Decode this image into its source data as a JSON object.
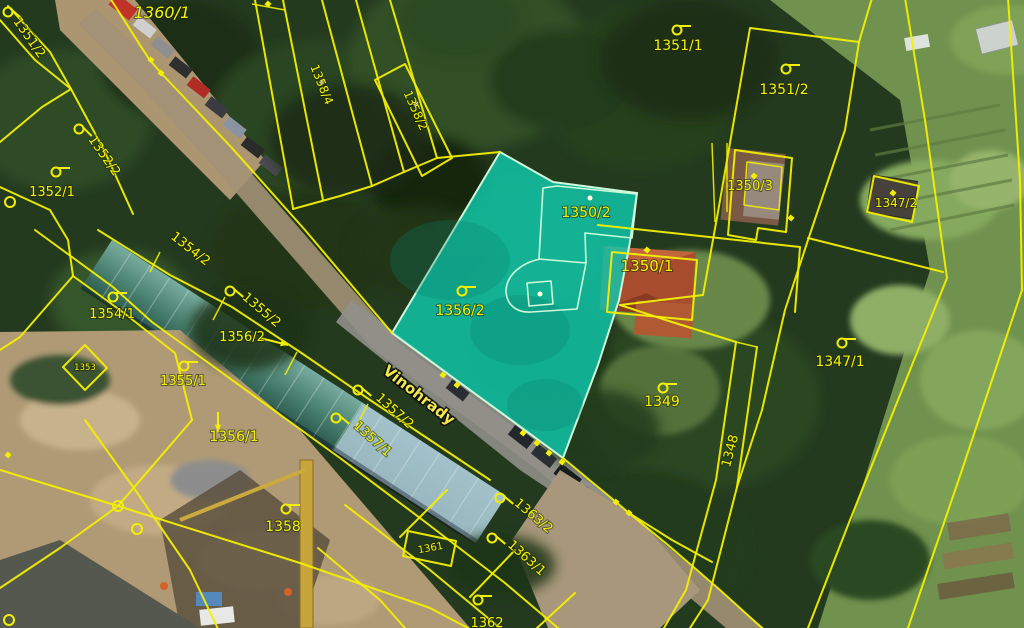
{
  "map": {
    "type": "cadastral-aerial-overlay",
    "street_label": {
      "text": "Vinohrady",
      "x": 416,
      "y": 399,
      "rot": 38,
      "size": 15
    },
    "highlighted_parcel": {
      "id": "1356/2",
      "fill": "rgba(16,201,173,0.82)",
      "outline": "#cdf8da"
    },
    "colors": {
      "boundary": "#f2ef00",
      "label": "#f4f200",
      "highlight_fill": "#10c9ad",
      "highlight_outline": "#cdf8da"
    },
    "parcel_labels": [
      {
        "text": "1360/1",
        "x": 162,
        "y": 18,
        "rot": 0,
        "size": 16,
        "italic": true
      },
      {
        "text": "1351/2",
        "x": 26,
        "y": 40,
        "rot": 55,
        "size": 13
      },
      {
        "text": "1352/2",
        "x": 101,
        "y": 158,
        "rot": 55,
        "size": 13
      },
      {
        "text": "1352/1",
        "x": 52,
        "y": 196,
        "rot": 0,
        "size": 13
      },
      {
        "text": "1358/4",
        "x": 318,
        "y": 86,
        "rot": 68,
        "size": 12
      },
      {
        "text": "1358/2",
        "x": 412,
        "y": 112,
        "rot": 66,
        "size": 12
      },
      {
        "text": "1351/1",
        "x": 678,
        "y": 50,
        "rot": 0,
        "size": 14
      },
      {
        "text": "1351/2",
        "x": 784,
        "y": 94,
        "rot": 0,
        "size": 14
      },
      {
        "text": "1350/3",
        "x": 750,
        "y": 190,
        "rot": 0,
        "size": 13
      },
      {
        "text": "1347/2",
        "x": 896,
        "y": 207,
        "rot": 0,
        "size": 12
      },
      {
        "text": "1350/2",
        "x": 586,
        "y": 217,
        "rot": 0,
        "size": 14
      },
      {
        "text": "1350/1",
        "x": 647,
        "y": 271,
        "rot": 0,
        "size": 15
      },
      {
        "text": "1356/2",
        "x": 460,
        "y": 315,
        "rot": 0,
        "size": 14
      },
      {
        "text": "1347/1",
        "x": 840,
        "y": 366,
        "rot": 0,
        "size": 14
      },
      {
        "text": "1349",
        "x": 662,
        "y": 406,
        "rot": 0,
        "size": 14
      },
      {
        "text": "1348",
        "x": 734,
        "y": 452,
        "rot": -75,
        "size": 13
      },
      {
        "text": "1354/2",
        "x": 188,
        "y": 252,
        "rot": 38,
        "size": 13
      },
      {
        "text": "1354/1",
        "x": 112,
        "y": 318,
        "rot": 0,
        "size": 13
      },
      {
        "text": "1355/2",
        "x": 259,
        "y": 313,
        "rot": 40,
        "size": 13
      },
      {
        "text": "1356/2",
        "x": 242,
        "y": 341,
        "rot": 0,
        "size": 13
      },
      {
        "text": "1353",
        "x": 85,
        "y": 370,
        "rot": 0,
        "size": 8.5
      },
      {
        "text": "1355/1",
        "x": 183,
        "y": 385,
        "rot": 0,
        "size": 13
      },
      {
        "text": "1356/1",
        "x": 234,
        "y": 441,
        "rot": 0,
        "size": 14
      },
      {
        "text": "1358",
        "x": 283,
        "y": 531,
        "rot": 0,
        "size": 14
      },
      {
        "text": "1361",
        "x": 431,
        "y": 551,
        "rot": -10,
        "size": 10
      },
      {
        "text": "1357/2",
        "x": 392,
        "y": 414,
        "rot": 42,
        "size": 13
      },
      {
        "text": "1357/1",
        "x": 370,
        "y": 442,
        "rot": 42,
        "size": 13
      },
      {
        "text": "1363/2",
        "x": 531,
        "y": 519,
        "rot": 40,
        "size": 13
      },
      {
        "text": "1363/1",
        "x": 524,
        "y": 561,
        "rot": 42,
        "size": 13
      },
      {
        "text": "1362",
        "x": 487,
        "y": 627,
        "rot": 0,
        "size": 13
      }
    ],
    "symbols": {
      "hooks": [
        {
          "x": 8,
          "y": 12,
          "rot": 40
        },
        {
          "x": 79,
          "y": 129,
          "rot": 45
        },
        {
          "x": 56,
          "y": 172,
          "rot": 0
        },
        {
          "x": 677,
          "y": 30,
          "rot": 0
        },
        {
          "x": 786,
          "y": 69,
          "rot": 0
        },
        {
          "x": 462,
          "y": 291,
          "rot": 0
        },
        {
          "x": 842,
          "y": 343,
          "rot": 0
        },
        {
          "x": 663,
          "y": 388,
          "rot": 0
        },
        {
          "x": 113,
          "y": 297,
          "rot": 0
        },
        {
          "x": 230,
          "y": 291,
          "rot": 40
        },
        {
          "x": 184,
          "y": 366,
          "rot": 0
        },
        {
          "x": 286,
          "y": 509,
          "rot": 0
        },
        {
          "x": 358,
          "y": 390,
          "rot": 40
        },
        {
          "x": 336,
          "y": 418,
          "rot": 40
        },
        {
          "x": 500,
          "y": 498,
          "rot": 40
        },
        {
          "x": 492,
          "y": 538,
          "rot": 40
        },
        {
          "x": 478,
          "y": 600,
          "rot": 0
        }
      ],
      "vertex_squares": [
        {
          "x": 151,
          "y": 60
        },
        {
          "x": 161,
          "y": 73
        },
        {
          "x": 268,
          "y": 4
        },
        {
          "x": 443,
          "y": 375
        },
        {
          "x": 457,
          "y": 385
        },
        {
          "x": 523,
          "y": 433
        },
        {
          "x": 537,
          "y": 443
        },
        {
          "x": 549,
          "y": 453
        },
        {
          "x": 562,
          "y": 462
        },
        {
          "x": 616,
          "y": 502
        },
        {
          "x": 629,
          "y": 513
        },
        {
          "x": 8,
          "y": 455
        },
        {
          "x": 791,
          "y": 218
        },
        {
          "x": 647,
          "y": 250
        },
        {
          "x": 754,
          "y": 176
        },
        {
          "x": 893,
          "y": 193
        }
      ],
      "pale_dots": [
        {
          "x": 590,
          "y": 198
        },
        {
          "x": 540,
          "y": 294
        },
        {
          "x": 416,
          "y": 104
        },
        {
          "x": 322,
          "y": 82
        }
      ],
      "vertex_rings": [
        {
          "x": 118,
          "y": 506
        },
        {
          "x": 137,
          "y": 529
        },
        {
          "x": 9,
          "y": 620
        },
        {
          "x": 10,
          "y": 202
        }
      ],
      "arrows": [
        {
          "x1": 260,
          "y1": 338,
          "x2": 288,
          "y2": 345
        },
        {
          "x1": 218,
          "y1": 412,
          "x2": 218,
          "y2": 432
        }
      ]
    }
  }
}
